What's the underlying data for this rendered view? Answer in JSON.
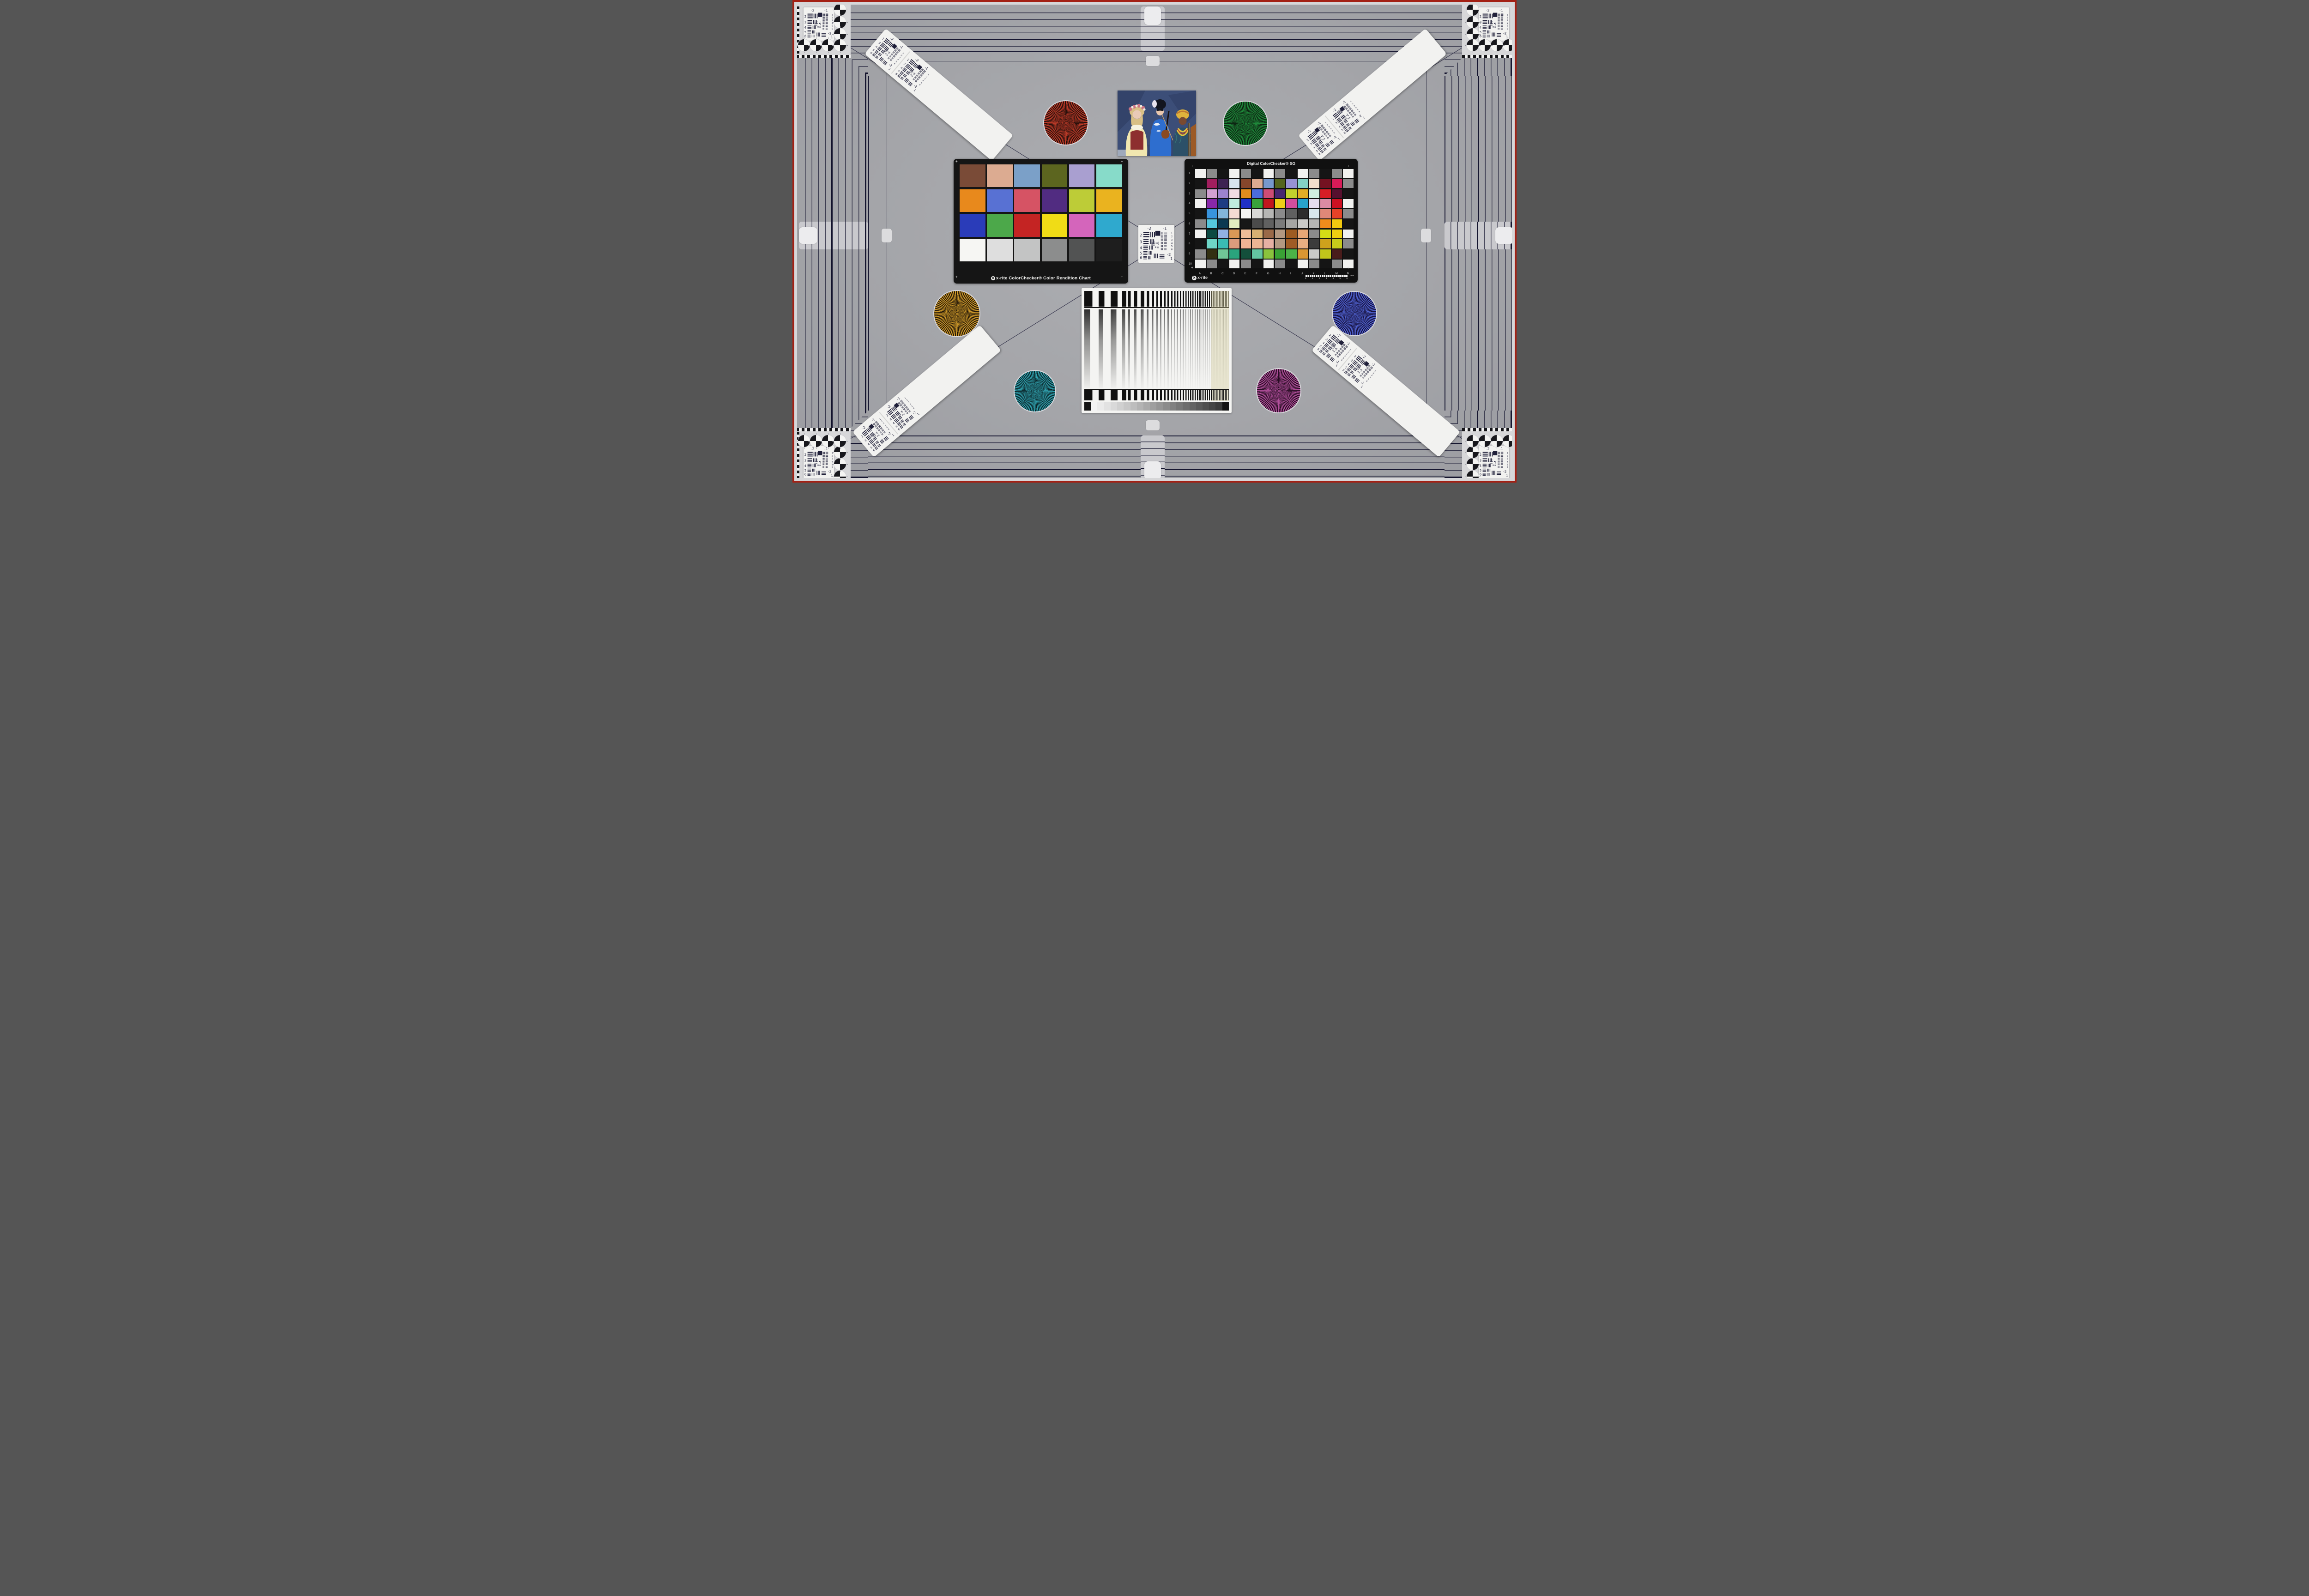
{
  "scene": {
    "description": "Camera test chart: striped reference frame, corner USAF targets with quadrant circles, diagonal resolution strips, six Siemens stars, ColorChecker cards, portrait card, frequency sweep with gray ramp",
    "background": "#a4a5a9",
    "margin": "#d6d6d8",
    "border_red": "#a32014",
    "panel": "#d7d7d9",
    "stripe_dark": "#16162e",
    "checker_dark": "#121216",
    "checker_light": "#f2f2f2"
  },
  "usaf": {
    "top_left": "-2",
    "top_right": "-1",
    "left": [
      "2",
      "3",
      "4",
      "5",
      "6"
    ],
    "right": [
      "1",
      "2",
      "3",
      "4",
      "5",
      "6"
    ],
    "corner": [
      "-2",
      "1"
    ],
    "micro": [
      "0",
      "1"
    ]
  },
  "stars": [
    {
      "name": "red-star",
      "bright": "#c33c29",
      "dark": "#200e0a"
    },
    {
      "name": "green-star",
      "bright": "#1f8f3c",
      "dark": "#0c1f10"
    },
    {
      "name": "orange-star",
      "bright": "#d29c2a",
      "dark": "#231708"
    },
    {
      "name": "blue-star",
      "bright": "#5266d6",
      "dark": "#140e38"
    },
    {
      "name": "teal-star",
      "bright": "#31a4b2",
      "dark": "#0a2327"
    },
    {
      "name": "magenta-star",
      "bright": "#b4509e",
      "dark": "#250c20"
    }
  ],
  "colorchecker24": {
    "label": "x-rite ColorChecker® Color Rendition Chart",
    "patches": [
      "#7a4b37",
      "#dcab91",
      "#7ba0c8",
      "#5c651f",
      "#a99fd0",
      "#87dbc9",
      "#e8891c",
      "#5871d3",
      "#d65364",
      "#512c81",
      "#bdcc37",
      "#eab31f",
      "#2a3cb9",
      "#4ca84a",
      "#c42423",
      "#f0dc16",
      "#d465bb",
      "#2fa9ce",
      "#f6f6f3",
      "#dedede",
      "#c3c4c4",
      "#8c8d8d",
      "#525353",
      "#1e1e1e"
    ]
  },
  "colorchecker_sg": {
    "title": "Digital ColorChecker® SG",
    "brand": "x-rite",
    "row_labels": [
      "1",
      "2",
      "3",
      "4",
      "5",
      "6",
      "7",
      "8",
      "9",
      "10"
    ],
    "col_labels": [
      "A",
      "B",
      "C",
      "D",
      "E",
      "F",
      "G",
      "H",
      "I",
      "J",
      "K",
      "L",
      "M",
      "N"
    ],
    "ruler_ticks": [
      "0",
      "1",
      "2",
      "3",
      "4",
      "5",
      "6"
    ],
    "ruler_unit": "mm",
    "patches": [
      [
        "#f2f2f0",
        "#8b8b8b",
        "#151515",
        "#f2f2f0",
        "#8b8b8b",
        "#151515",
        "#f2f2f0",
        "#8b8b8b",
        "#151515",
        "#f2f2f0",
        "#8b8b8b",
        "#151515",
        "#8b8b8b",
        "#f2f2f0"
      ],
      [
        "#151515",
        "#a21e5e",
        "#3d2252",
        "#d7e3ed",
        "#86462b",
        "#dcab90",
        "#7798cc",
        "#54641e",
        "#9792d3",
        "#84d2c6",
        "#f1e0cd",
        "#741221",
        "#d71b58",
        "#8b8b8b"
      ],
      [
        "#8b8b8b",
        "#d2a1d1",
        "#9c83cd",
        "#f2dce3",
        "#e18c1e",
        "#4b6cda",
        "#cd4c75",
        "#482670",
        "#c2d12d",
        "#e3ae25",
        "#d0efe1",
        "#d71e25",
        "#560f2e",
        "#151515"
      ],
      [
        "#f2f2f0",
        "#8828a9",
        "#1e3c83",
        "#c0ebde",
        "#2030c6",
        "#38a23b",
        "#c1161d",
        "#eece18",
        "#d34e9d",
        "#28a3cc",
        "#e5ddef",
        "#db8ba3",
        "#ce1022",
        "#f2f2f0"
      ],
      [
        "#151515",
        "#3894de",
        "#83b5db",
        "#f5dbd3",
        "#f5f5f3",
        "#d8d8d6",
        "#b6b6b4",
        "#8b8b8b",
        "#606060",
        "#2c2c2c",
        "#d8e7ed",
        "#e08878",
        "#e74228",
        "#8b8b8b"
      ],
      [
        "#8b8b8b",
        "#55c7dc",
        "#0b3951",
        "#e2eec0",
        "#171717",
        "#4b4b4b",
        "#606060",
        "#7b7b7b",
        "#a6a6a4",
        "#cbcbc9",
        "#b6b6b4",
        "#ee8c1c",
        "#f2c910",
        "#151515"
      ],
      [
        "#f2f2f0",
        "#0c4941",
        "#91b1e2",
        "#db9957",
        "#edbc98",
        "#d7b072",
        "#9a6948",
        "#b39881",
        "#9d5b21",
        "#e7a776",
        "#8b8b8b",
        "#d5dd16",
        "#efd011",
        "#f2f2f0"
      ],
      [
        "#151515",
        "#6ed5c7",
        "#3abbb3",
        "#dc9c7d",
        "#efb394",
        "#edb594",
        "#e7b0a3",
        "#b39881",
        "#9f5b25",
        "#e9af82",
        "#3c3c3c",
        "#cea11c",
        "#c7cb1b",
        "#8b8b8b"
      ],
      [
        "#8b8b8b",
        "#322f11",
        "#70c696",
        "#2aa47d",
        "#134f3b",
        "#63c5a1",
        "#8ac33d",
        "#39a234",
        "#4bb247",
        "#db9632",
        "#cbcbc9",
        "#c1c51b",
        "#491c1b",
        "#151515"
      ],
      [
        "#f2f2f0",
        "#8b8b8b",
        "#151515",
        "#f2f2f0",
        "#8b8b8b",
        "#151515",
        "#f2f2f0",
        "#8b8b8b",
        "#151515",
        "#f2f2f0",
        "#8b8b8b",
        "#151515",
        "#8b8b8b",
        "#f2f2f0"
      ]
    ]
  },
  "sweep": {
    "bar_color": "#101010",
    "line_color": "#2e2e2e",
    "periods": [
      36,
      26,
      19,
      14,
      10.5,
      8,
      6.3,
      5,
      4,
      3.2
    ],
    "segment_opacity": [
      1,
      0.95,
      0.9,
      0.85,
      0.78,
      0.7,
      0.62,
      0.55,
      0.48,
      0.42
    ],
    "ramp": [
      "#141414",
      "#f3f3f3",
      "#ebebeb",
      "#e2e2e2",
      "#d9d9d9",
      "#d0d0d0",
      "#c7c7c7",
      "#bdbdbd",
      "#b3b3b3",
      "#a9a9a9",
      "#9f9f9f",
      "#959595",
      "#8b8b8b",
      "#818181",
      "#777777",
      "#6d6d6d",
      "#636363",
      "#595959",
      "#4f4f4f",
      "#454545",
      "#3b3b3b",
      "#141414"
    ]
  },
  "photo": {
    "name": "three musicians portrait card",
    "backdrop": "#3c4e78",
    "backdrop_dark": "#2b3a5e",
    "left_skin": "#e9cab6",
    "left_hair": "#d8bf85",
    "left_blouse": "#f1e7b0",
    "left_vest": "#8d2f2f",
    "center_hair": "#12151f",
    "center_skin": "#eac8ae",
    "kimono": "#2e6ecf",
    "right_skin": "#7a4a30",
    "turban": "#e0b33c",
    "robe": "#2c5068",
    "necklace": "#e3c13c",
    "violin": "#8a4a22",
    "cello": "#9c5a26",
    "floor": "#b8c0cc"
  }
}
